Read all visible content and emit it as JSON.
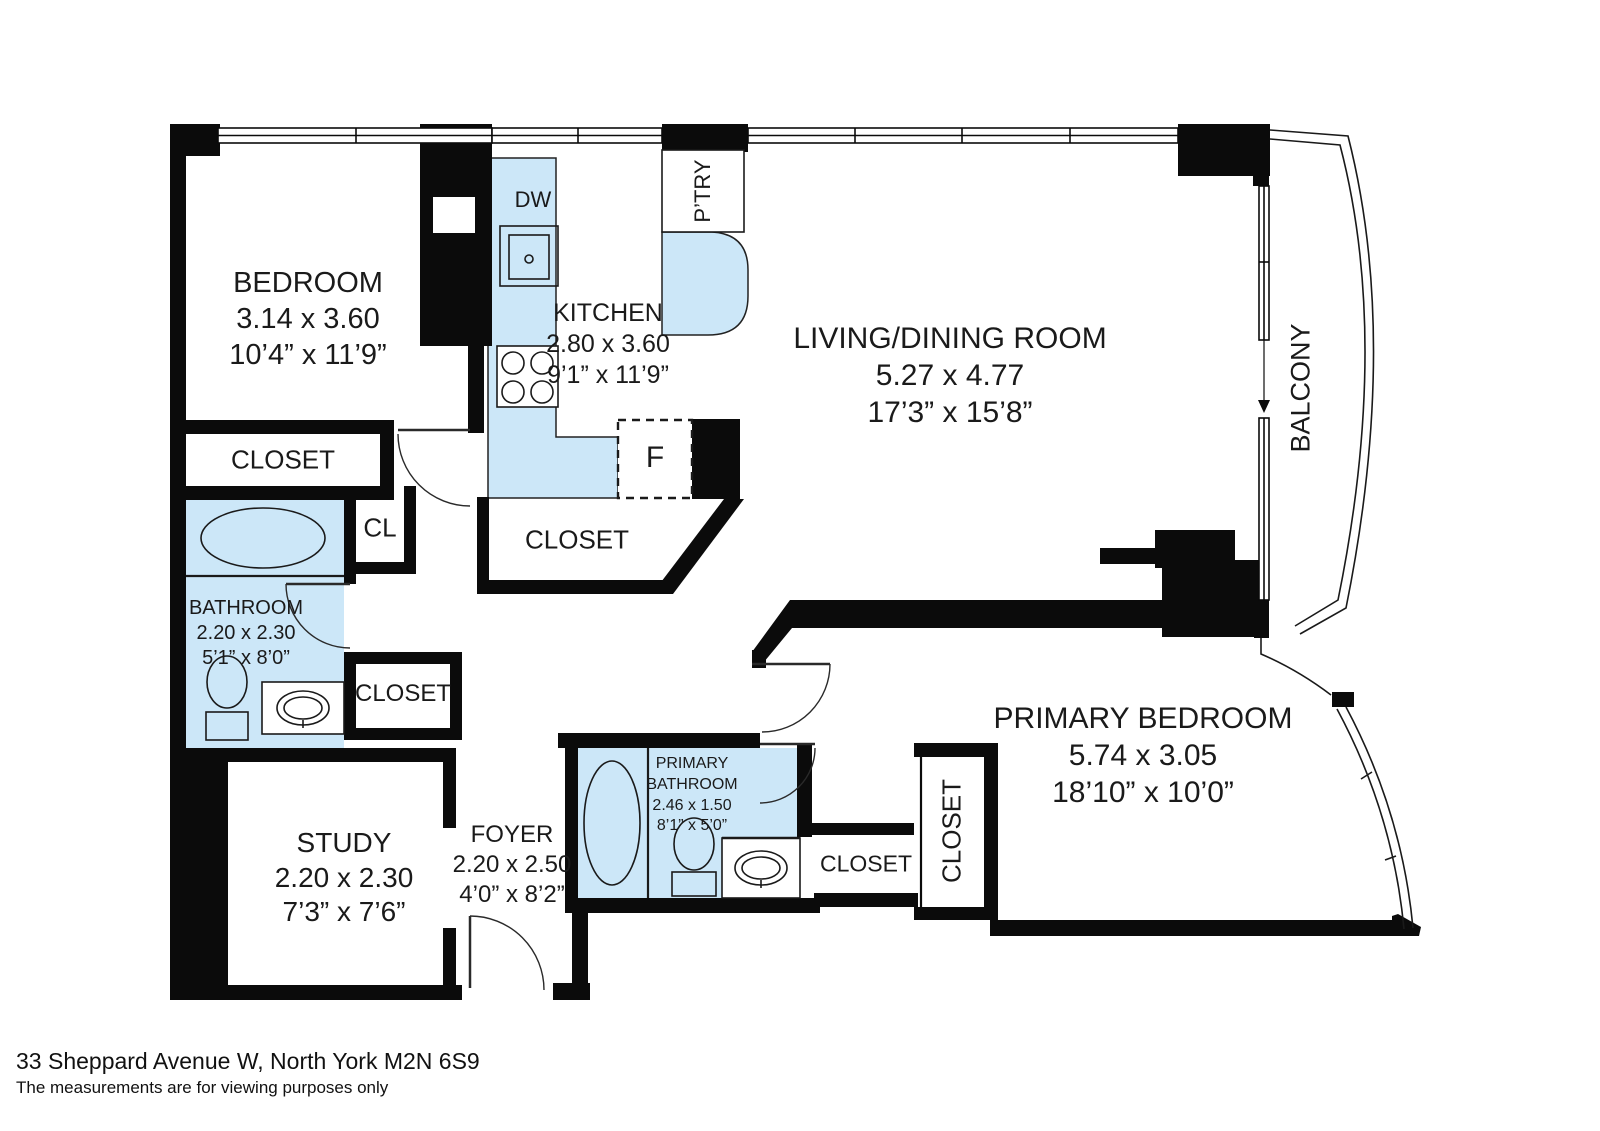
{
  "meta": {
    "address_line1": "33 Sheppard Avenue W, North York M2N 6S9",
    "address_line2": "The measurements are for viewing purposes only"
  },
  "rooms": {
    "bedroom": {
      "name": "BEDROOM",
      "metric": "3.14 x 3.60",
      "imperial": "10’4” x 11’9”"
    },
    "kitchen": {
      "name": "KITCHEN",
      "metric": "2.80 x 3.60",
      "imperial": "9’1” x 11’9”"
    },
    "living_dining": {
      "name": "LIVING/DINING ROOM",
      "metric": "5.27 x 4.77",
      "imperial": "17’3” x 15’8”"
    },
    "bathroom": {
      "name": "BATHROOM",
      "metric": "2.20 x 2.30",
      "imperial": "5’1” x 8’0”"
    },
    "study": {
      "name": "STUDY",
      "metric": "2.20 x 2.30",
      "imperial": "7’3” x 7’6”"
    },
    "foyer": {
      "name": "FOYER",
      "metric": "2.20 x 2.50",
      "imperial": "4’0” x 8’2”"
    },
    "primary_bathroom": {
      "name_line1": "PRIMARY",
      "name_line2": "BATHROOM",
      "metric": "2.46 x 1.50",
      "imperial": "8’1” x 5’0”"
    },
    "primary_bedroom": {
      "name": "PRIMARY BEDROOM",
      "metric": "5.74 x 3.05",
      "imperial": "18’10” x 10’0”"
    },
    "balcony": {
      "name": "BALCONY"
    }
  },
  "labels": {
    "closet": "CLOSET",
    "small_closet": "CL",
    "pantry": "P’TRY",
    "dishwasher": "DW",
    "fridge": "F"
  },
  "colors": {
    "wall": "#0b0b0b",
    "fixture_fill": "#cce7f8",
    "line": "#1a1a1a"
  }
}
